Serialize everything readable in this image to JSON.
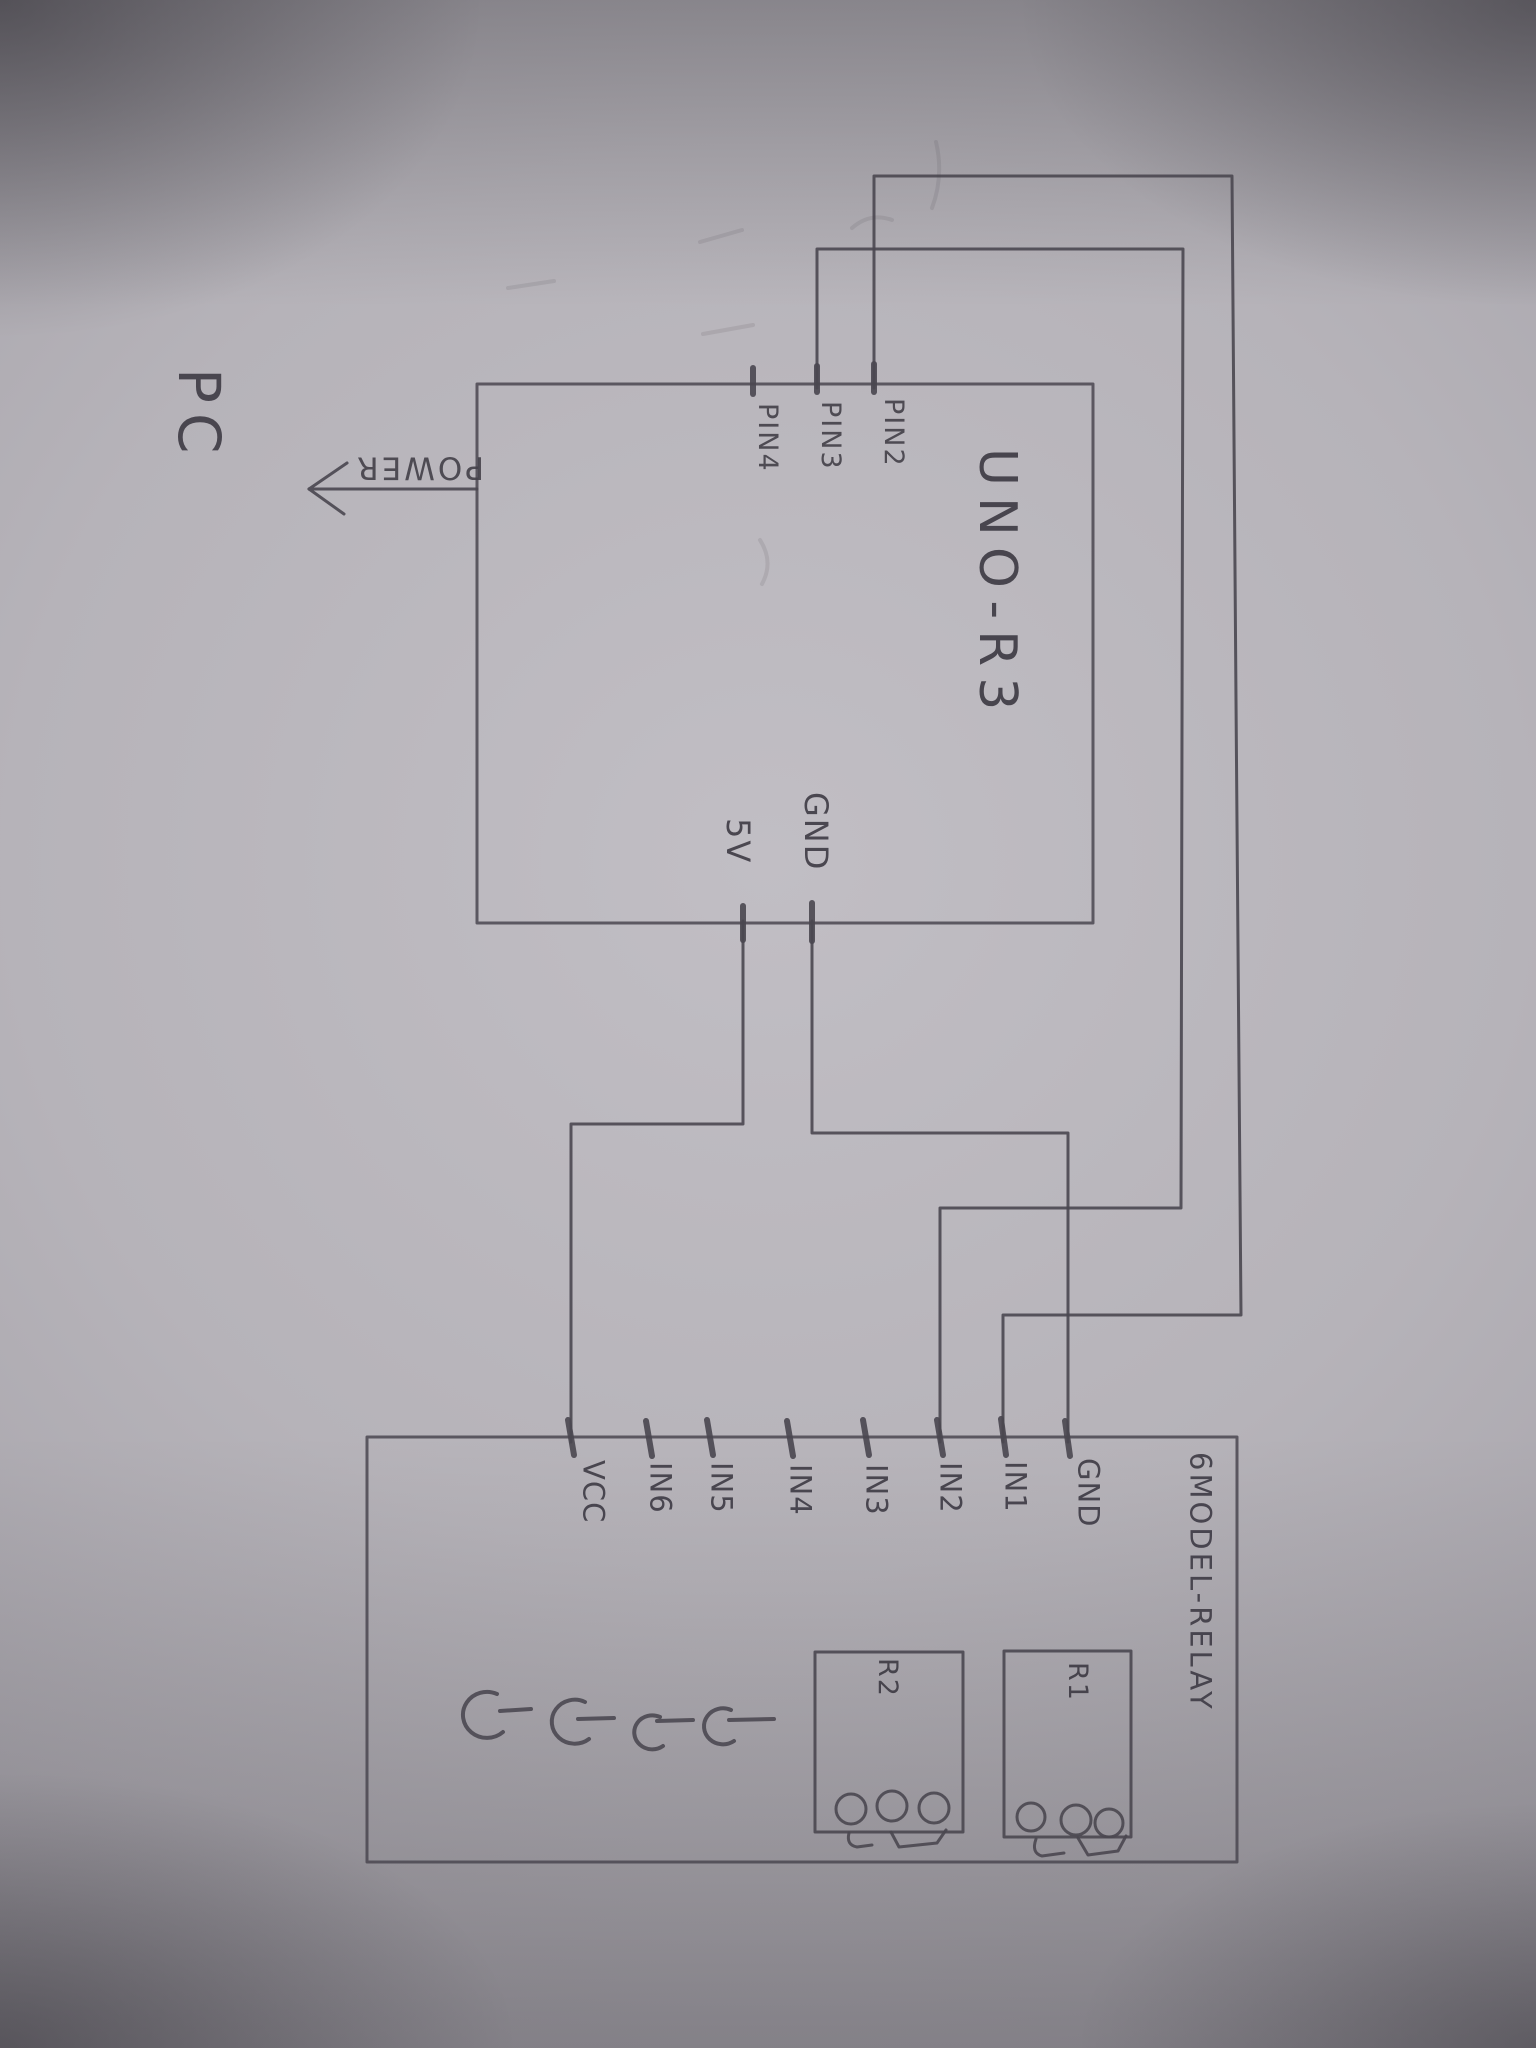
{
  "labels": {
    "pc": "PC",
    "power": "POWER"
  },
  "uno": {
    "title": "UNO-R3",
    "top_pins": [
      "PIN2",
      "PIN3",
      "PIN4"
    ],
    "bottom_pins": [
      "5V",
      "GND"
    ]
  },
  "relay": {
    "title": "6MODEL-RELAY",
    "pins": [
      "VCC",
      "IN6",
      "IN5",
      "IN4",
      "IN3",
      "IN2",
      "IN1",
      "GND"
    ],
    "modules": [
      {
        "label": "R1"
      },
      {
        "label": "R2"
      }
    ]
  },
  "colors": {
    "pencil": "#4a4750",
    "paper": "#b2afb5"
  }
}
